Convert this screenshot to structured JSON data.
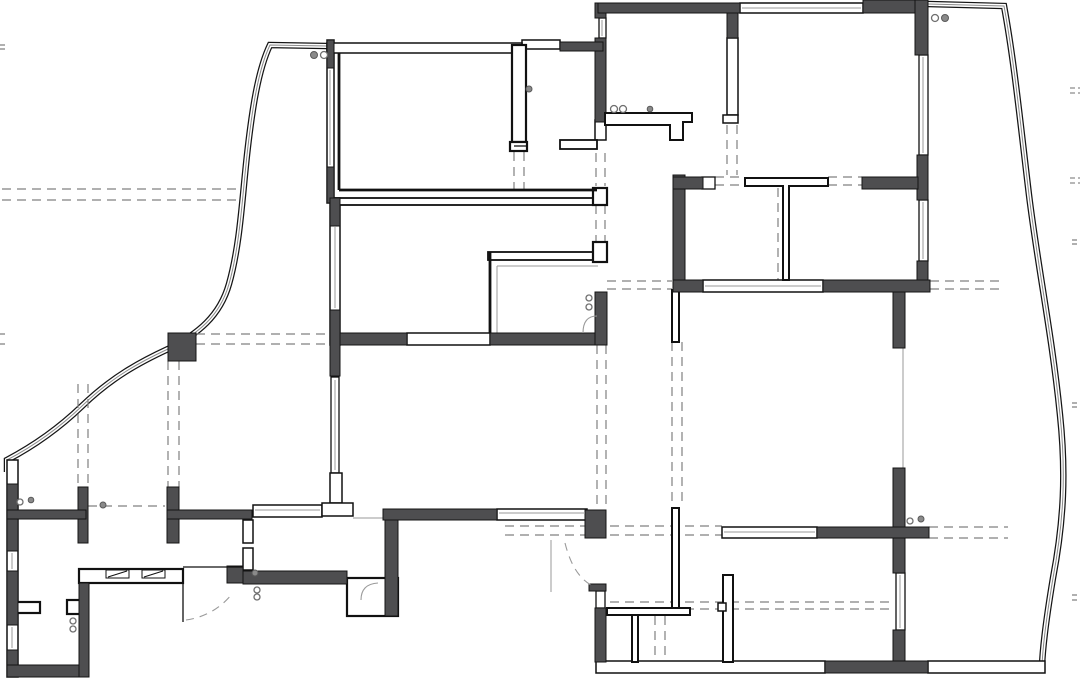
{
  "canvas": {
    "width": 1080,
    "height": 680
  },
  "colors": {
    "wall_fill": "#4e4e50",
    "line": "#111111",
    "dash": "#808080",
    "glass_mid": "#8a8a8a",
    "background": "#ffffff"
  },
  "floorplan": {
    "glass_walls": [
      "M327,46 L270,45 C258,70 252,110 247,155 C242,200 240,245 229,284 C220,316 198,334 168,349 C140,362 112,377 82,406 C54,433 26,450 7,460 L7,472",
      "M928,4 L1004,6 C1014,60 1020,120 1029,195 C1038,268 1052,335 1060,415 C1066,472 1064,520 1053,578 C1048,608 1043,640 1042,666"
    ],
    "dashed_lines": [
      [
        196,
        334,
        331,
        334
      ],
      [
        196,
        344,
        331,
        344
      ],
      [
        2,
        189,
        240,
        189
      ],
      [
        2,
        200,
        240,
        200
      ],
      [
        607,
        281,
        672,
        281
      ],
      [
        607,
        289,
        672,
        289
      ],
      [
        930,
        281,
        1005,
        281
      ],
      [
        930,
        289,
        1005,
        289
      ],
      [
        715,
        177,
        745,
        177
      ],
      [
        715,
        185,
        745,
        185
      ],
      [
        828,
        177,
        862,
        177
      ],
      [
        828,
        185,
        862,
        185
      ],
      [
        505,
        526,
        722,
        526
      ],
      [
        505,
        535,
        722,
        535
      ],
      [
        929,
        527,
        1008,
        527
      ],
      [
        929,
        538,
        1008,
        538
      ],
      [
        610,
        602,
        890,
        602
      ],
      [
        610,
        609,
        890,
        609
      ],
      [
        88,
        506,
        165,
        506
      ],
      [
        514,
        152,
        514,
        190
      ],
      [
        524,
        152,
        524,
        190
      ],
      [
        727,
        125,
        727,
        175
      ],
      [
        737,
        125,
        737,
        175
      ],
      [
        596,
        153,
        596,
        186
      ],
      [
        605,
        153,
        605,
        186
      ],
      [
        596,
        205,
        596,
        242
      ],
      [
        605,
        205,
        605,
        242
      ],
      [
        597,
        345,
        597,
        508
      ],
      [
        606,
        345,
        606,
        508
      ],
      [
        672,
        342,
        672,
        507
      ],
      [
        682,
        342,
        682,
        507
      ],
      [
        168,
        361,
        168,
        487
      ],
      [
        179,
        361,
        179,
        487
      ],
      [
        78,
        384,
        78,
        487
      ],
      [
        88,
        384,
        88,
        487
      ],
      [
        778,
        188,
        778,
        280
      ],
      [
        787,
        188,
        787,
        280
      ],
      [
        655,
        616,
        655,
        660
      ],
      [
        665,
        616,
        665,
        660
      ]
    ],
    "edge_ticks": [
      [
        0,
        45,
        8,
        45
      ],
      [
        0,
        49,
        8,
        49
      ],
      [
        0,
        334,
        8,
        334
      ],
      [
        0,
        344,
        8,
        344
      ],
      [
        1070,
        88,
        1080,
        88
      ],
      [
        1070,
        93,
        1080,
        93
      ],
      [
        1070,
        178,
        1080,
        178
      ],
      [
        1070,
        183,
        1080,
        183
      ],
      [
        1072,
        240,
        1080,
        240
      ],
      [
        1072,
        244,
        1080,
        244
      ],
      [
        1072,
        403,
        1080,
        403
      ],
      [
        1072,
        407,
        1080,
        407
      ],
      [
        1072,
        595,
        1080,
        595
      ],
      [
        1072,
        600,
        1080,
        600
      ]
    ],
    "light_walls": [
      [
        327,
        40,
        7,
        163,
        1.5
      ],
      [
        330,
        198,
        10,
        147,
        1.5
      ],
      [
        7,
        460,
        11,
        217,
        1.5
      ],
      [
        740,
        3,
        123,
        10,
        1.5
      ],
      [
        919,
        55,
        9,
        100,
        1.3
      ],
      [
        919,
        200,
        9,
        61,
        1.3
      ],
      [
        727,
        38,
        11,
        77,
        1.5
      ],
      [
        723,
        115,
        15,
        8,
        1.5
      ],
      [
        703,
        280,
        120,
        12,
        1.5
      ],
      [
        702,
        177,
        13,
        12,
        1.3
      ],
      [
        896,
        573,
        9,
        57,
        1.3
      ],
      [
        928,
        661,
        117,
        12,
        1.5
      ],
      [
        596,
        661,
        229,
        12,
        1.5
      ],
      [
        722,
        527,
        95,
        11,
        1.5
      ],
      [
        497,
        509,
        90,
        11,
        1.5
      ],
      [
        253,
        505,
        69,
        12,
        1.5
      ],
      [
        407,
        333,
        83,
        12,
        1.5
      ],
      [
        595,
        120,
        11,
        20,
        1.5
      ],
      [
        560,
        140,
        37,
        9,
        1.8
      ],
      [
        522,
        40,
        38,
        9,
        1.5
      ],
      [
        327,
        43,
        195,
        10,
        1.5
      ],
      [
        333,
        198,
        260,
        7,
        1.8
      ],
      [
        488,
        252,
        112,
        8,
        1.8
      ],
      [
        593,
        188,
        14,
        17,
        2.2
      ],
      [
        593,
        242,
        14,
        20,
        2.2
      ],
      [
        512,
        45,
        14,
        97,
        2.2
      ],
      [
        510,
        142,
        17,
        9,
        2.2
      ],
      [
        347,
        578,
        51,
        38,
        2.2
      ],
      [
        79,
        569,
        104,
        14,
        2.2
      ],
      [
        67,
        600,
        13,
        14,
        2.2
      ],
      [
        13,
        602,
        27,
        11,
        2.2
      ],
      [
        672,
        508,
        7,
        100,
        2
      ],
      [
        632,
        615,
        6,
        47,
        2
      ],
      [
        607,
        608,
        83,
        7,
        2
      ],
      [
        723,
        575,
        10,
        87,
        2
      ],
      [
        718,
        603,
        8,
        8,
        1.5
      ],
      [
        672,
        290,
        7,
        52,
        2
      ],
      [
        243,
        520,
        10,
        23,
        1.5
      ],
      [
        243,
        548,
        10,
        22,
        1.5
      ],
      [
        331,
        377,
        8,
        96,
        1.3
      ],
      [
        330,
        473,
        12,
        30,
        1.5
      ],
      [
        322,
        503,
        31,
        13,
        1.5
      ],
      [
        596,
        591,
        9,
        17,
        1.3
      ],
      [
        599,
        18,
        7,
        20,
        1.3
      ]
    ],
    "dark_walls": [
      [
        595,
        3,
        11,
        15
      ],
      [
        598,
        3,
        142,
        10
      ],
      [
        727,
        13,
        11,
        25
      ],
      [
        863,
        0,
        65,
        13
      ],
      [
        915,
        0,
        13,
        55
      ],
      [
        917,
        155,
        11,
        45
      ],
      [
        917,
        261,
        11,
        31
      ],
      [
        595,
        38,
        11,
        84
      ],
      [
        560,
        42,
        43,
        9
      ],
      [
        673,
        175,
        12,
        117
      ],
      [
        673,
        177,
        30,
        12
      ],
      [
        862,
        177,
        56,
        12
      ],
      [
        673,
        280,
        30,
        12
      ],
      [
        823,
        280,
        107,
        12
      ],
      [
        893,
        292,
        12,
        56
      ],
      [
        893,
        468,
        12,
        105
      ],
      [
        893,
        630,
        12,
        43
      ],
      [
        825,
        661,
        103,
        12
      ],
      [
        585,
        510,
        21,
        28
      ],
      [
        589,
        584,
        17,
        7
      ],
      [
        595,
        608,
        11,
        54
      ],
      [
        383,
        509,
        114,
        11
      ],
      [
        385,
        520,
        13,
        96
      ],
      [
        338,
        333,
        69,
        12
      ],
      [
        490,
        333,
        117,
        12
      ],
      [
        595,
        292,
        12,
        53
      ],
      [
        330,
        310,
        10,
        66
      ],
      [
        327,
        40,
        7,
        28
      ],
      [
        327,
        167,
        7,
        36
      ],
      [
        330,
        198,
        10,
        28
      ],
      [
        7,
        484,
        11,
        67
      ],
      [
        7,
        571,
        11,
        54
      ],
      [
        7,
        650,
        11,
        27
      ],
      [
        7,
        665,
        82,
        12
      ],
      [
        79,
        583,
        10,
        94
      ],
      [
        78,
        487,
        10,
        56
      ],
      [
        167,
        487,
        12,
        56
      ],
      [
        7,
        510,
        79,
        9
      ],
      [
        167,
        510,
        85,
        9
      ],
      [
        227,
        566,
        16,
        17
      ],
      [
        243,
        571,
        104,
        13
      ],
      [
        168,
        333,
        28,
        28
      ],
      [
        817,
        527,
        112,
        11
      ]
    ],
    "window_lines": [
      [
        923,
        57,
        923,
        153
      ],
      [
        923,
        202,
        923,
        259
      ],
      [
        900,
        575,
        900,
        628
      ],
      [
        12,
        553,
        12,
        569
      ],
      [
        12,
        627,
        12,
        648
      ],
      [
        330,
        70,
        330,
        165
      ],
      [
        335,
        227,
        335,
        308
      ],
      [
        335,
        380,
        335,
        470
      ],
      [
        602,
        20,
        602,
        36
      ],
      [
        499,
        513,
        585,
        513
      ],
      [
        742,
        8,
        861,
        8
      ],
      [
        255,
        510,
        320,
        510
      ],
      [
        705,
        286,
        821,
        286
      ],
      [
        724,
        532,
        815,
        532
      ]
    ],
    "thick_lines": [
      [
        339,
        53,
        339,
        190
      ],
      [
        339,
        190,
        597,
        190
      ],
      [
        490,
        252,
        490,
        333
      ]
    ],
    "thin_lines": [
      [
        183,
        567,
        243,
        567
      ],
      [
        183,
        569,
        183,
        622
      ],
      [
        514,
        146,
        526,
        146
      ]
    ],
    "gray_lines": [
      [
        903,
        348,
        903,
        468
      ],
      [
        551,
        540,
        551,
        592
      ],
      [
        497,
        266,
        497,
        333
      ],
      [
        497,
        266,
        598,
        266
      ],
      [
        353,
        518,
        383,
        518
      ]
    ],
    "fixture_paths": [
      "M605,113 L692,113 L692,122 L683,122 L683,140 L670,140 L670,125 L605,125 Z",
      "M745,178 L828,178 L828,186 L789,186 L789,280 L783,280 L783,186 L745,186 Z"
    ],
    "door_arcs": [
      {
        "d": "M565,543 Q573,575 591,585",
        "dashed": true
      },
      {
        "d": "M186,620 Q214,616 232,594",
        "dashed": true
      },
      {
        "d": "M583,333 Q583,316 597,316",
        "dashed": false
      },
      {
        "d": "M361,600 Q361,584 378,583",
        "dashed": false
      }
    ],
    "hatch_boxes": [
      {
        "rect": [
          106,
          570,
          23,
          8
        ],
        "diag": [
          108,
          577,
          127,
          571
        ]
      },
      {
        "rect": [
          142,
          570,
          23,
          8
        ],
        "diag": [
          144,
          577,
          163,
          571
        ]
      }
    ],
    "symbol_circles": [
      {
        "cx": 314,
        "cy": 55,
        "r": 3.5,
        "filled": true
      },
      {
        "cx": 324,
        "cy": 55,
        "r": 3.5,
        "filled": false
      },
      {
        "cx": 935,
        "cy": 18,
        "r": 3.5,
        "filled": false
      },
      {
        "cx": 945,
        "cy": 18,
        "r": 3.5,
        "filled": true
      },
      {
        "cx": 614,
        "cy": 109,
        "r": 3.5,
        "filled": false
      },
      {
        "cx": 623,
        "cy": 109,
        "r": 3.5,
        "filled": false
      },
      {
        "cx": 650,
        "cy": 109,
        "r": 2.8,
        "filled": true
      },
      {
        "cx": 529,
        "cy": 89,
        "r": 3,
        "filled": true
      },
      {
        "cx": 589,
        "cy": 298,
        "r": 3,
        "filled": false
      },
      {
        "cx": 589,
        "cy": 307,
        "r": 3,
        "filled": false
      },
      {
        "cx": 910,
        "cy": 521,
        "r": 3,
        "filled": false
      },
      {
        "cx": 921,
        "cy": 519,
        "r": 3,
        "filled": true
      },
      {
        "cx": 255,
        "cy": 573,
        "r": 3,
        "filled": true
      },
      {
        "cx": 257,
        "cy": 590,
        "r": 3,
        "filled": false
      },
      {
        "cx": 257,
        "cy": 597,
        "r": 3,
        "filled": false
      },
      {
        "cx": 73,
        "cy": 621,
        "r": 3,
        "filled": false
      },
      {
        "cx": 73,
        "cy": 629,
        "r": 3,
        "filled": false
      },
      {
        "cx": 20,
        "cy": 502,
        "r": 3,
        "filled": false
      },
      {
        "cx": 31,
        "cy": 500,
        "r": 2.8,
        "filled": true
      },
      {
        "cx": 103,
        "cy": 505,
        "r": 3,
        "filled": true
      }
    ]
  }
}
